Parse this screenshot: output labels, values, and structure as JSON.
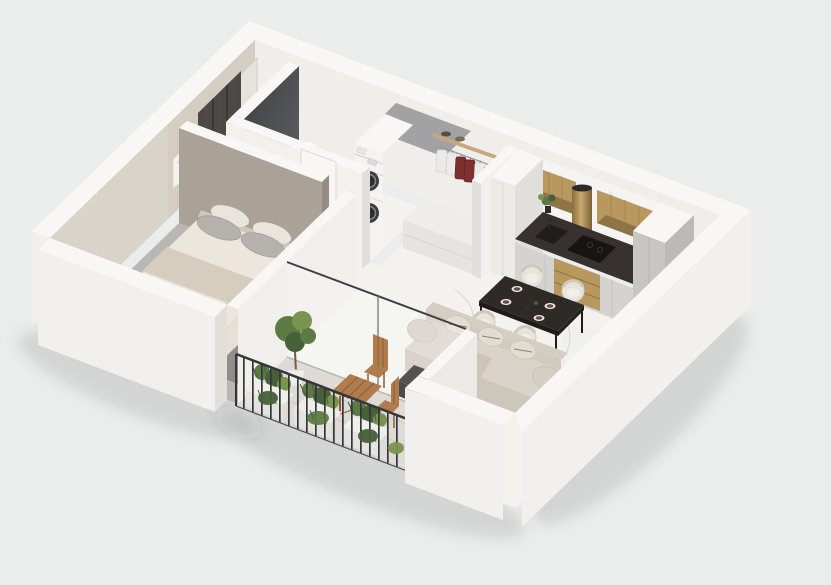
{
  "meta": {
    "scene_label": "Isometric 3D cutaway floor plan render of a one-bedroom apartment with balcony"
  },
  "palette": {
    "bg": "#ebecec",
    "wall_top": "#f8f7f5",
    "wall_outer": "#f1f0ee",
    "wall_inner": "#efeeeb",
    "wall_shade": "#e0dfdc",
    "wall_dark": "#4a4b4e",
    "wall_taupe": "#aaa197",
    "wall_taupe_side": "#948b82",
    "wall_beige": "#d5cdc2",
    "wall_beige_light": "#d9d3ca",
    "floor_marble": "#f3f2ef",
    "floor_vein": "#d8d6d2",
    "floor_bedroom": "#b9b7b4",
    "rug": "#8f8d8a",
    "floor_balcony": "#dedbd6",
    "counter_dark": "#37322f",
    "cabinet_light": "#d5d3d0",
    "cabinet_gold": "#b8985e",
    "cabinet_gold_dark": "#8f7546",
    "brass": "#ab8752",
    "tall_gray": "#c8c6c3",
    "dining_dark": "#2e2a28",
    "chair_cream": "#e9e4da",
    "sofa": "#d9d3c9",
    "sofa_dark": "#cdc6bb",
    "sofa_back": "#d4cec4",
    "bed_linen": "#ece6dc",
    "bed_blanket": "#d7cdbf",
    "pillow_gray": "#b5b1ac",
    "wood": "#b07c4e",
    "wood_dark": "#8a5f33",
    "railing": "#34363a",
    "plant": "#5d7a44",
    "plant_dark": "#46603a",
    "plant_light": "#79944f",
    "garment_red": "#7c3030",
    "garment_white": "#eceae6",
    "appliance_dark": "#3b3c3f",
    "glass": "rgba(255,255,255,0.22)",
    "shadow": "rgba(30,30,30,0.10)"
  },
  "scene": {
    "view": "axonometric cutaway, walls cut at uniform height",
    "rooms": [
      {
        "name": "bathroom",
        "furniture": [
          "freestanding-bathtub",
          "round-basin-on-wood-stand",
          "round-mirror",
          "toilet",
          "stacked-washer-dryer",
          "linen-shelves",
          "dark-accent-wall"
        ]
      },
      {
        "name": "entry-hall",
        "furniture": [
          "entry-door",
          "dark-textured-wardrobe-panels",
          "wall-art-frame"
        ]
      },
      {
        "name": "closet",
        "furniture": [
          "wood-shelf",
          "clothes-rail",
          "hanging-garments",
          "low-white-cabinet"
        ]
      },
      {
        "name": "kitchen",
        "furniture": [
          "marble-backsplash",
          "gold-upper-cabinets",
          "brass-cylinder-hood",
          "tall-white-cabinet",
          "tall-gray-cabinet",
          "dark-countertop",
          "inset-sink",
          "cooktop",
          "gold-drawer-unit",
          "counter-plant"
        ]
      },
      {
        "name": "dining-area",
        "furniture": [
          "dark-marble-dining-table",
          "cream-barrel-chair-x4",
          "table-place-settings"
        ]
      },
      {
        "name": "living-room",
        "furniture": [
          "cream-curved-sofa",
          "back-cushions",
          "throw-blanket",
          "dark-gold-coffee-table",
          "sliding-glass-door"
        ]
      },
      {
        "name": "bedroom",
        "furniture": [
          "taupe-accent-wall",
          "dark-gray-rug",
          "double-bed",
          "gray-pillows",
          "beige-throw",
          "white-shelf-unit"
        ]
      },
      {
        "name": "balcony",
        "furniture": [
          "black-metal-railing",
          "planter-box-x3",
          "wooden-folding-table",
          "wooden-folding-chair-x2",
          "potted-tree"
        ]
      }
    ]
  }
}
